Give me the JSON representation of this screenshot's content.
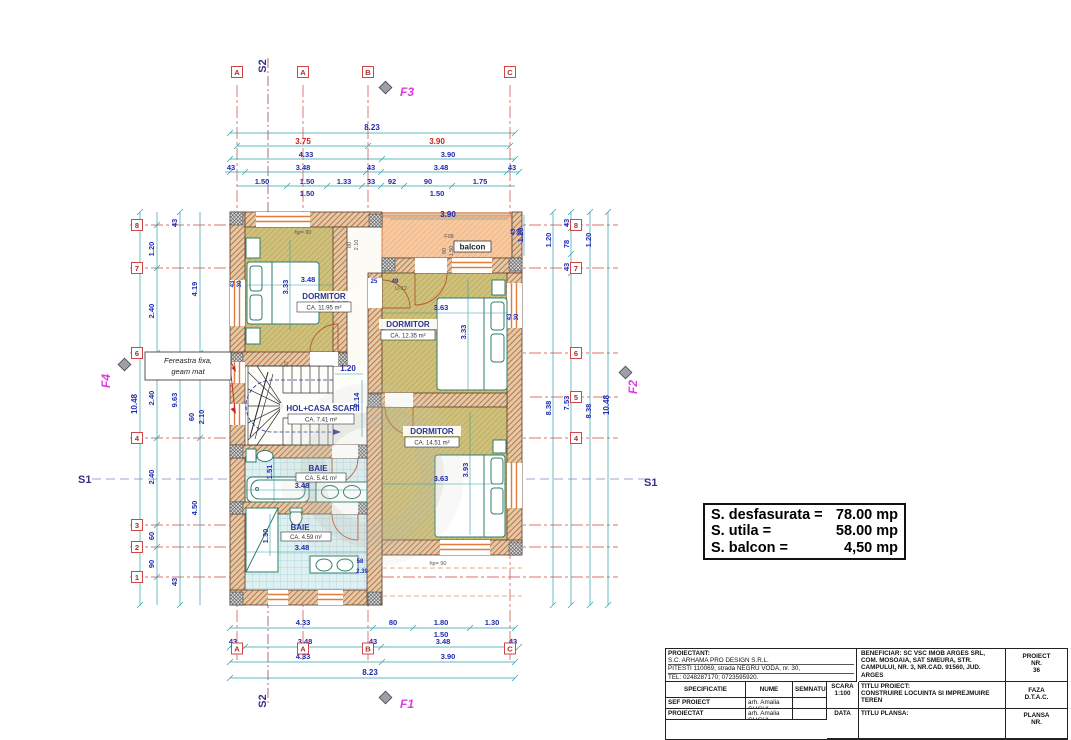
{
  "colors": {
    "wall_hatch": "#b0603a",
    "wall_bg": "#e3c9a4",
    "floor_bg": "#cfc07a",
    "floor_hatch": "#a89a52",
    "tile_bg": "#dff0f2",
    "tile_grid": "#a3ced6",
    "balcony_bg": "#f7c9a0",
    "balcony_hatch": "#eaa06d",
    "dim_line": "#2fa0a8",
    "dim_text": "#1f2bb0",
    "axis_red": "#cc4444",
    "marker_magenta": "#e23ae2",
    "section_navy": "#3a2f86",
    "fixture_green": "#2f7d6a"
  },
  "grid": {
    "top": [
      "A",
      "A",
      "B",
      "C"
    ],
    "bottom": [
      "A",
      "A",
      "B",
      "C"
    ],
    "left": [
      "8",
      "7",
      "6",
      "4",
      "3",
      "2",
      "1"
    ],
    "right": [
      "8",
      "7",
      "6",
      "5",
      "4"
    ]
  },
  "markers": {
    "f1": "F1",
    "f2": "F2",
    "f3": "F3",
    "f4": "F4",
    "s1": "S1",
    "s2": "S2"
  },
  "rooms": {
    "dormitor1": {
      "name": "DORMITOR",
      "area": "CA.   11.95 m²",
      "w": "3.48",
      "h": "3.33"
    },
    "dormitor2": {
      "name": "DORMITOR",
      "area": "CA.   12.35 m²",
      "w": "3.63",
      "h": "3.33"
    },
    "dormitor3": {
      "name": "DORMITOR",
      "area": "CA.   14.51 m²",
      "w": "3.63",
      "h": "3.93"
    },
    "hol": {
      "name": "HOL+CASA SCARII",
      "area": "CA.   7.41 m²",
      "w": "1.20",
      "h": "2.14"
    },
    "baie1": {
      "name": "BAIE",
      "area": "CA.   5.41 m²",
      "w": "3.48",
      "h": "1.51"
    },
    "baie2": {
      "name": "BAIE",
      "area": "CA.   4.59 m²",
      "w": "3.48",
      "h": "1.30"
    },
    "balcon": {
      "name": "balcon",
      "w": "3.90",
      "h": "1.20"
    }
  },
  "annotations": {
    "window_note_1": "Fereastra fixa,",
    "window_note_2": "geam mat",
    "f08": "F08",
    "f08_w": "90",
    "f08_h": "1.50",
    "parapet_top": "hp= 90",
    "parapet_bottom": "hp= 90",
    "door_w": "80",
    "door_h": "2.10",
    "door_u12": "U-12",
    "stair_riser": "27",
    "tag_25": "25",
    "tag_49": "49",
    "tag_43a": "43",
    "tag_30a": "30",
    "tag_43b": "43",
    "tag_30b": "30",
    "tag_43c": "43",
    "tag_30c": "30",
    "tag_58": "58",
    "tag_239": "2.39"
  },
  "dims": {
    "top": {
      "total": "8.23",
      "axis": [
        "3.75",
        "3.90"
      ],
      "row3": [
        "4.33",
        "3.90"
      ],
      "row4": [
        "43",
        "3.48",
        "43",
        "3.48",
        "43"
      ],
      "row5": [
        "1.50",
        "1.50",
        "1.33",
        "33",
        "92",
        "90",
        "1.75"
      ],
      "sub": [
        "1.50",
        "1.50"
      ]
    },
    "bottom": {
      "row1": [
        "4.33",
        "80",
        "1.80",
        "1.30"
      ],
      "sub": "1.50",
      "row2": [
        "43",
        "3.48",
        "43",
        "3.48",
        "43"
      ],
      "row3": [
        "4.33",
        "3.90"
      ],
      "total": "8.23"
    },
    "left": {
      "total": "10.48",
      "c963": "9.63",
      "c419": "4.19",
      "c450": "4.50",
      "t43a": "43",
      "t43b": "43",
      "win": [
        "60",
        "2.10",
        "60",
        "2.10"
      ],
      "chain": [
        "1.20",
        "2.40",
        "2.40",
        "2.40",
        "60",
        "90"
      ]
    },
    "right": {
      "chain": [
        "1.20",
        "43",
        "78",
        "43",
        "1.20"
      ],
      "c838a": "8.38",
      "c753": "7.53",
      "c838b": "8.38",
      "total": "10.48"
    }
  },
  "summary": {
    "rows": [
      [
        "S. desfasurata =",
        "78.00 mp"
      ],
      [
        "S. utila =",
        "58.00 mp"
      ],
      [
        "S. balcon =",
        "4,50 mp"
      ]
    ]
  },
  "titleblock": {
    "proiectant_label": "PROIECTANT:",
    "proiectant_line1": "S.C. ARHAMA PRO DESIGN S.R.L.",
    "proiectant_line2": "PITESTI 110069, strada NEGRU VODA, nr. 30,",
    "proiectant_line3": "TEL: 0248287170; 0723595920.",
    "col_specificatie": "SPECIFICATIE",
    "col_nume": "NUME",
    "col_semnatura": "SEMNATURA",
    "row_sef_label": "SEF PROIECT",
    "row_sef_name": "arh. Amalia GUGUI",
    "row_proiectat_label": "PROIECTAT",
    "row_proiectat_name": "arh. Amalia GUGUI",
    "scara_label": "SCARA",
    "scara_value": "1:100",
    "data_label": "DATA",
    "beneficiar_label": "BENEFICIAR:",
    "beneficiar_line1": "SC VSC IMOB ARGES SRL,",
    "beneficiar_line2": "COM. MOSOAIA, SAT SMEURA, STR.",
    "beneficiar_line3": "CAMPULUI, NR. 3, NR.CAD. 91560, JUD.",
    "beneficiar_line4": "ARGES",
    "titlu_proiect_label": "TITLU PROIECT:",
    "titlu_proiect_line1": "CONSTRUIRE LOCUINTA SI IMPREJMUIRE",
    "titlu_proiect_line2": "TEREN",
    "titlu_plansa_label": "TITLU PLANSA:",
    "proiect_label": "PROIECT",
    "proiect_nr_label": "NR.",
    "proiect_nr_value": "36",
    "faza_label": "FAZA",
    "faza_value": "D.T.A.C.",
    "plansa_label": "PLANSA",
    "plansa_nr_label": "NR."
  }
}
